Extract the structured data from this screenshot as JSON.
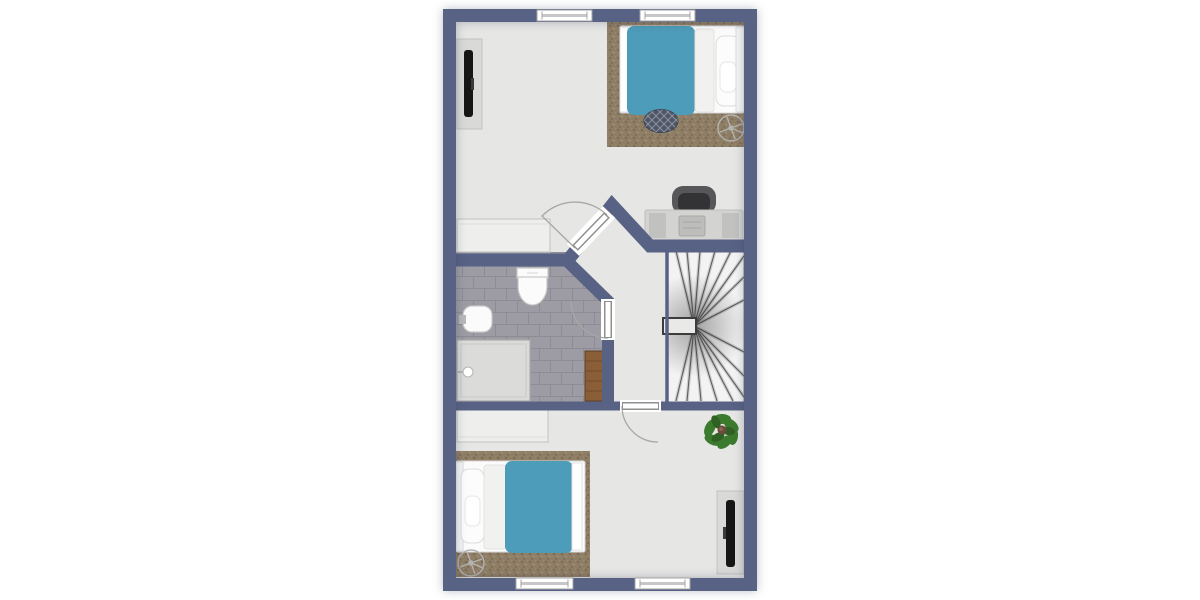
{
  "plan": {
    "kind": "floor-plan",
    "rooms": [
      {
        "name": "bedroom-top",
        "furniture": [
          "wall-tv",
          "rug",
          "double-bed-teal",
          "ottoman-pouf",
          "ceiling-fan",
          "desk",
          "desk-chair",
          "dresser"
        ]
      },
      {
        "name": "bathroom",
        "furniture": [
          "toilet",
          "wall-sink",
          "walk-in-shower",
          "wood-bath-mat"
        ],
        "floor": "gray-brick-tile"
      },
      {
        "name": "hallway",
        "furniture": []
      },
      {
        "name": "staircase",
        "furniture": [
          "winder-stairs",
          "newel-post"
        ]
      },
      {
        "name": "bedroom-bottom",
        "furniture": [
          "dresser",
          "rug",
          "double-bed-teal",
          "ceiling-fan",
          "potted-plant",
          "wall-tv"
        ]
      }
    ],
    "window_count": 4,
    "door_count": 3
  },
  "colors": {
    "background": "#ffffff",
    "wall": "#586284",
    "floor": "#e6e6e4",
    "stairs": "#f3f3f3",
    "tile": "#9d9ca4",
    "tile_grout": "#8d8c95",
    "rug": "#8f7e66",
    "bed_duvet": "#4d9cb9",
    "bed_frame": "#fbfbfb",
    "sheet": "#f1f1f0",
    "wood": "#8a5f38",
    "plant": "#3c7a2e",
    "plant_dark": "#2e6123",
    "tv": "#161616",
    "tv_stand": "#d9d9d7",
    "desk": "#d3d3d2",
    "desk_panel": "#c1c1c0",
    "chair": "#57575a",
    "chair_seat": "#333336",
    "pouf": "#4e5668",
    "dresser": "#eeeeec",
    "fixture": "#fbfbfb"
  }
}
